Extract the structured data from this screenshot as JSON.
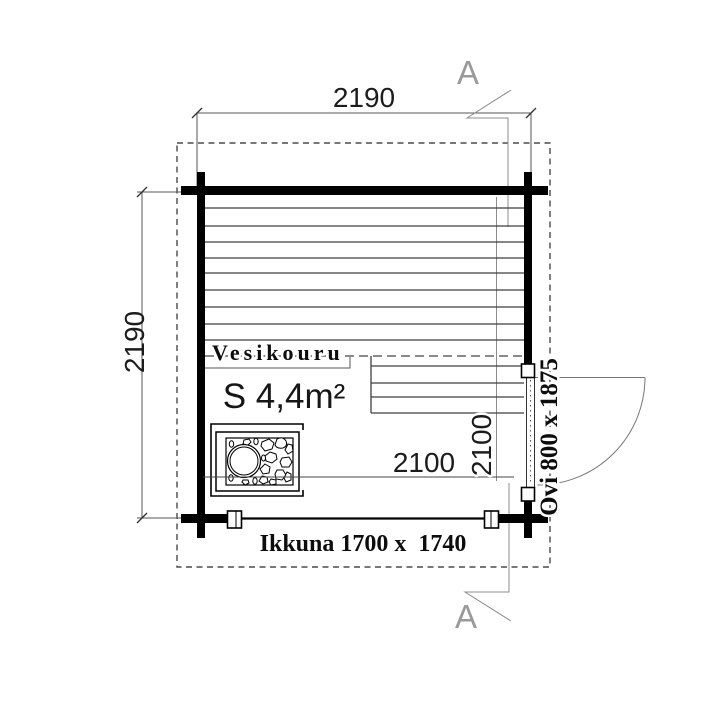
{
  "labels": {
    "overall_width": "2190",
    "overall_depth": "2190",
    "interior_width": "2100",
    "interior_depth": "2100",
    "area": "S 4,4m²",
    "gutter": "Vesikouru",
    "window": "Ikkuna 1700 x  1740",
    "door": "Ovi 800 x 1875",
    "section_top": "A",
    "section_bottom": "A"
  },
  "colors": {
    "background": "#ffffff",
    "wall": "#000000",
    "thin_line": "#3f3f3f",
    "dashed_roof": "#4a4a4a",
    "gutter_dash": "#8a8a8a",
    "callout": "#8c8c8c",
    "text": "#111111",
    "section_letter": "#9a9a9a"
  }
}
